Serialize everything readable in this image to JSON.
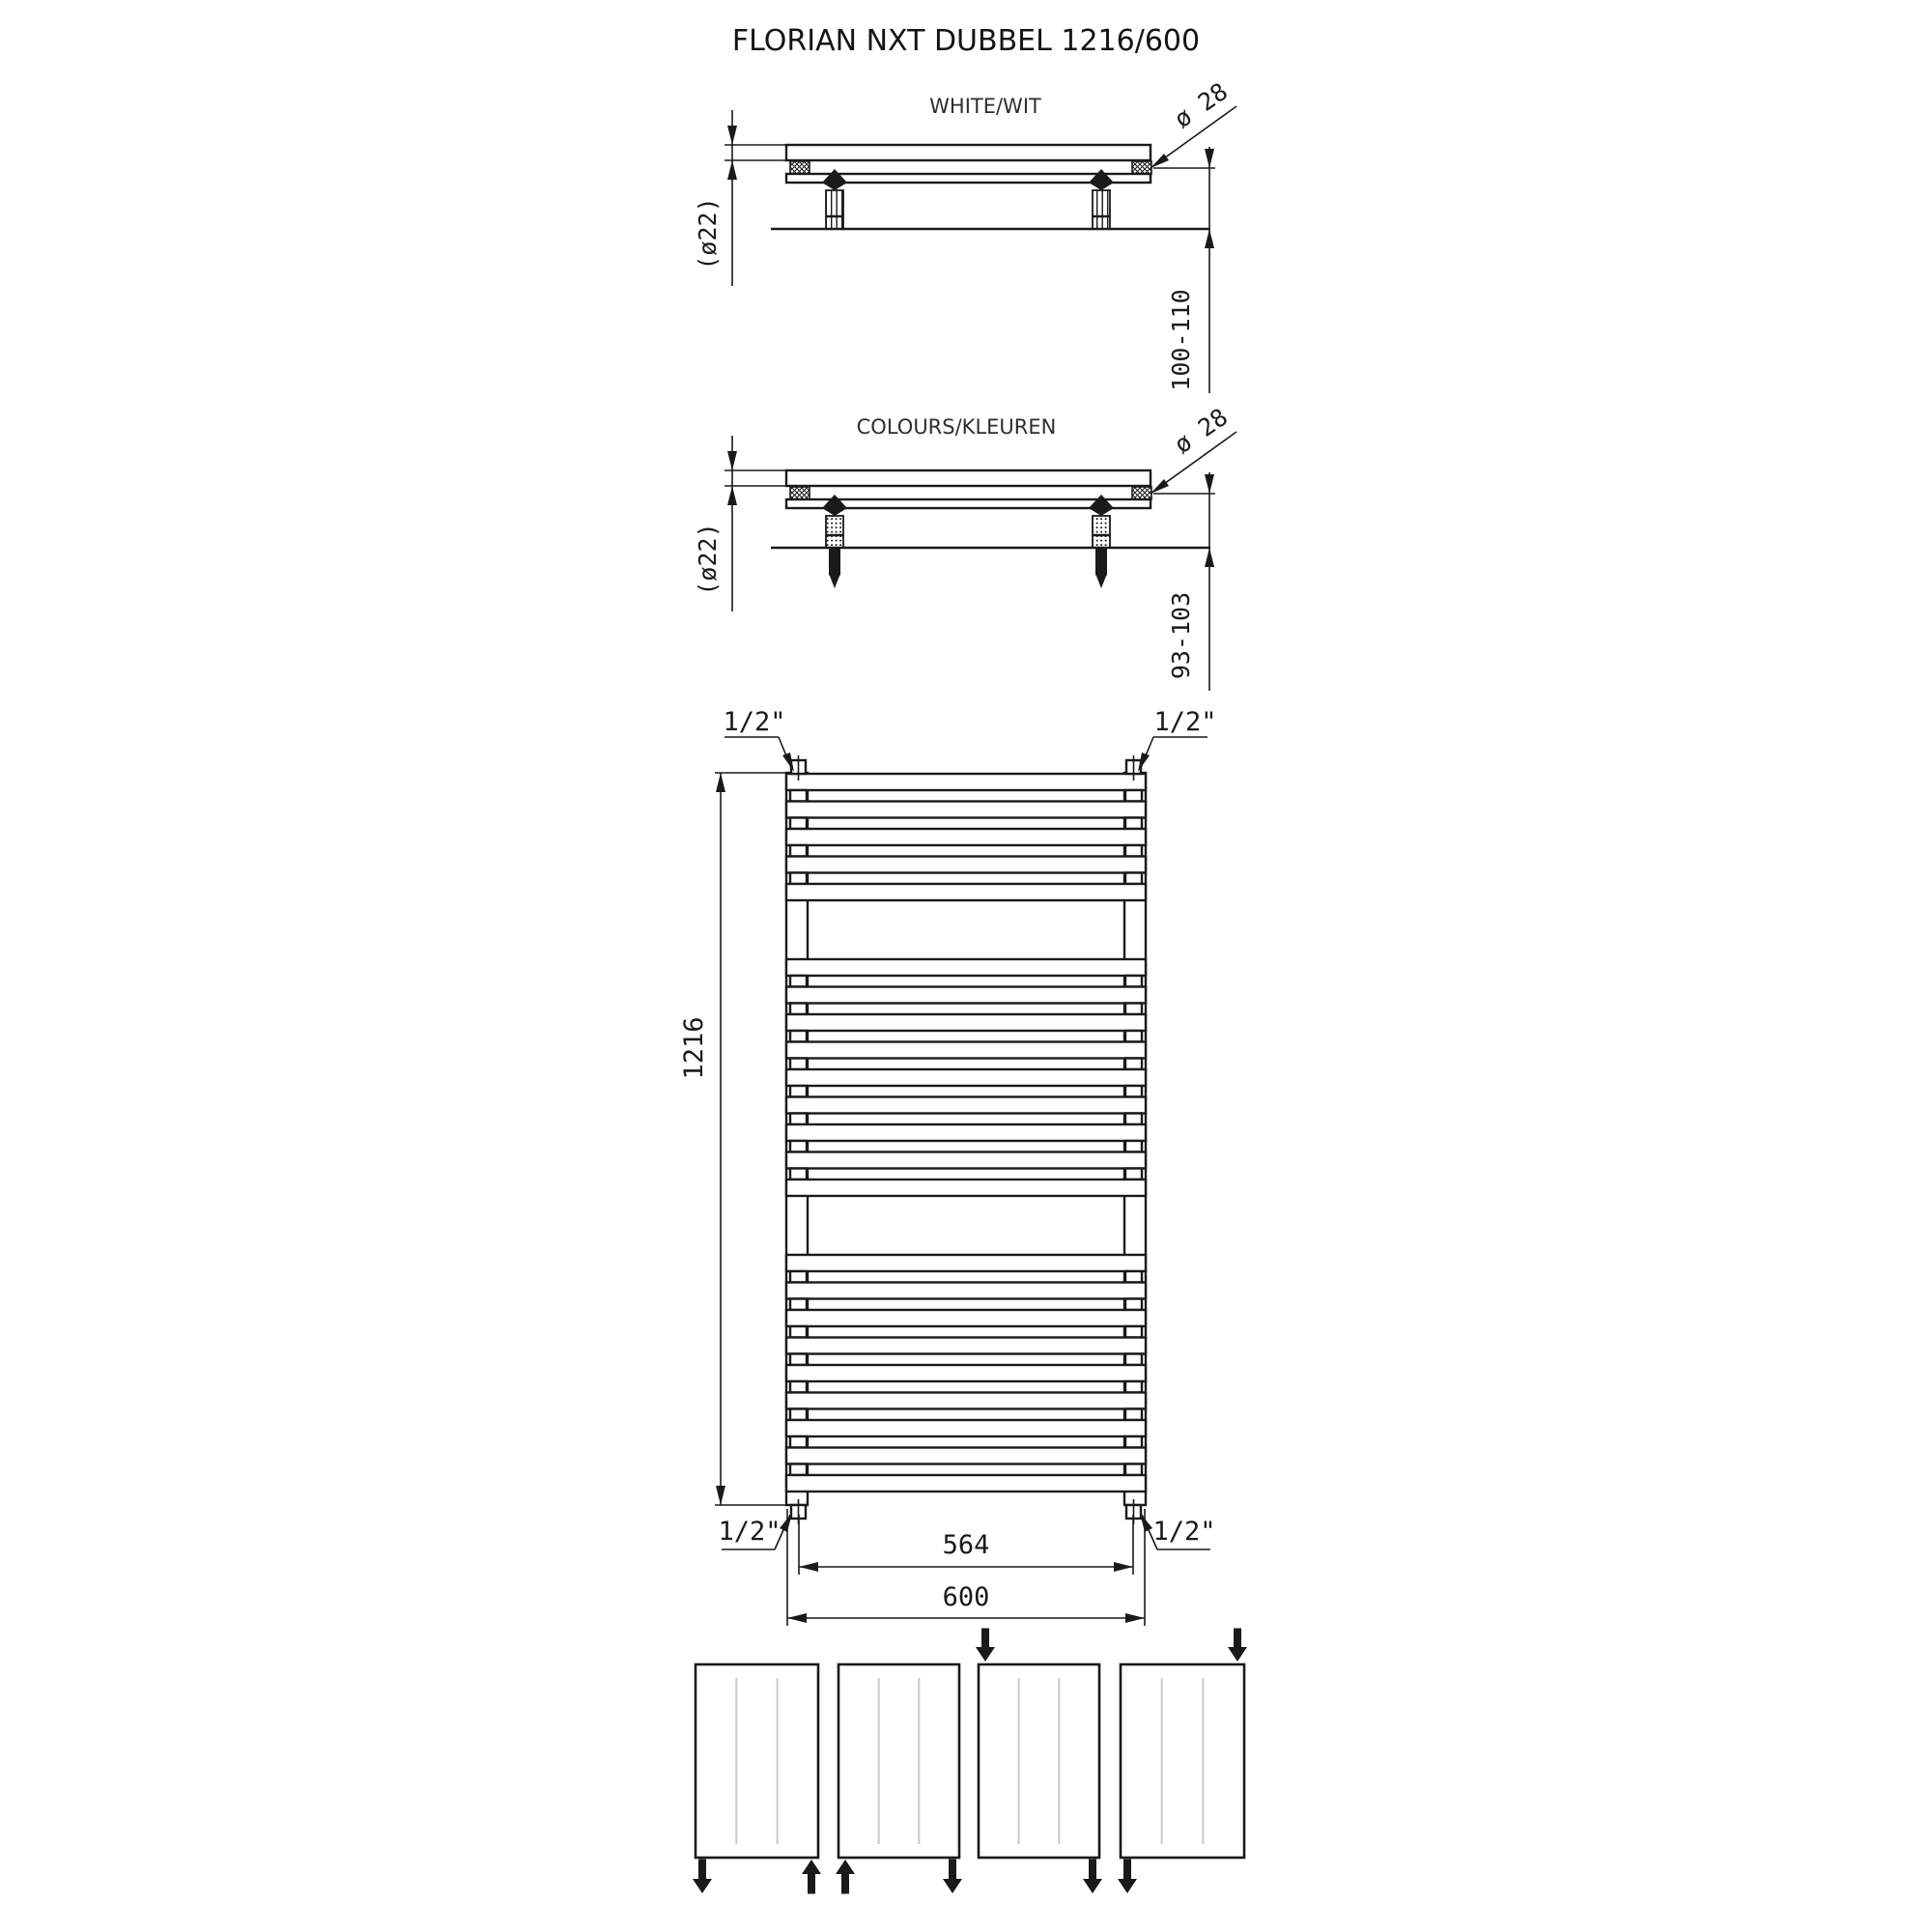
{
  "title": "FLORIAN NXT DUBBEL 1216/600",
  "side_views": {
    "white": {
      "label": "WHITE/WIT",
      "tube_diameter": "(ø22)",
      "collector_diameter": "ø 28",
      "wall_distance": "100-110"
    },
    "colours": {
      "label": "COLOURS/KLEUREN",
      "tube_diameter": "(ø22)",
      "collector_diameter": "ø 28",
      "wall_distance": "93-103"
    }
  },
  "front_view": {
    "height": "1216",
    "connection_spacing": "564",
    "width": "600",
    "connections": {
      "top_left": "1/2\"",
      "top_right": "1/2\"",
      "bottom_left": "1/2\"",
      "bottom_right": "1/2\""
    },
    "tube_groups": [
      5,
      9,
      9
    ]
  },
  "connection_diagrams": [
    {
      "arrows": [
        {
          "pos": "bottom-left",
          "dir": "down"
        },
        {
          "pos": "bottom-right",
          "dir": "up"
        }
      ]
    },
    {
      "arrows": [
        {
          "pos": "bottom-left",
          "dir": "up"
        },
        {
          "pos": "bottom-right",
          "dir": "down"
        }
      ]
    },
    {
      "arrows": [
        {
          "pos": "top-left",
          "dir": "down"
        },
        {
          "pos": "bottom-right",
          "dir": "down"
        }
      ]
    },
    {
      "arrows": [
        {
          "pos": "top-right",
          "dir": "down"
        },
        {
          "pos": "bottom-left",
          "dir": "down"
        }
      ]
    }
  ],
  "colors": {
    "line": "#1a1a1a",
    "faint": "#c9c9c9",
    "background": "#ffffff"
  }
}
